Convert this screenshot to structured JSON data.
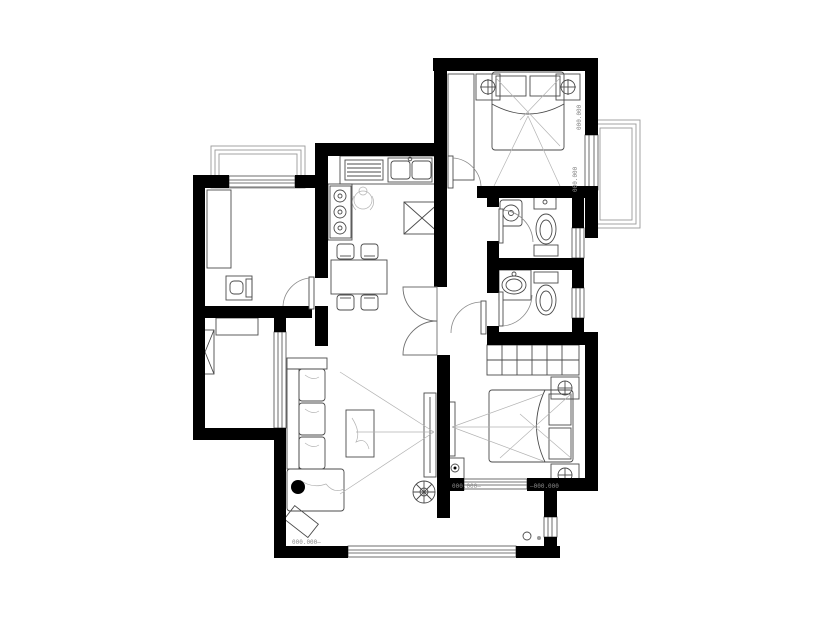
{
  "title": "apartment floor plan drawing",
  "colors": {
    "background": "#ffffff",
    "wall": "#000000",
    "furniture_line": "#4b4b4b",
    "light_guide_line": "#b3b3b3",
    "window_line": "#4a4a4a",
    "dimension_text": "#8a8a8a"
  },
  "dimension_labels": [
    {
      "text": "000.000—"
    },
    {
      "text": "000.000—"
    },
    {
      "text": "—000.000"
    },
    {
      "text": "000.000"
    },
    {
      "text": "000.000"
    }
  ],
  "rooms": [
    {
      "name": "bedroom-top-right",
      "furniture": [
        "wardrobe",
        "double-bed",
        "pillows",
        "nightstand-left",
        "nightstand-right",
        "table-lamps",
        "balcony-bay-window",
        "entry-door"
      ]
    },
    {
      "name": "kitchen",
      "furniture": [
        "counter",
        "double-sink",
        "dish-rack",
        "cooktop",
        "refrigerator",
        "figure"
      ]
    },
    {
      "name": "study-room",
      "furniture": [
        "wardrobe",
        "desk",
        "chair",
        "bay-window",
        "entry-door"
      ]
    },
    {
      "name": "bathroom-upper",
      "furniture": [
        "washing-machine",
        "small-basin",
        "toilet",
        "entry-door",
        "window"
      ]
    },
    {
      "name": "bathroom-lower",
      "furniture": [
        "vanity-counter",
        "basin",
        "toilet",
        "entry-door",
        "window"
      ]
    },
    {
      "name": "dining-area",
      "furniture": [
        "dining-table",
        "chairs-x4",
        "double-swing-door"
      ]
    },
    {
      "name": "living-room",
      "furniture": [
        "l-sofa",
        "chaise",
        "side-table",
        "coffee-table",
        "tv-stand",
        "plant",
        "west-window",
        "south-window"
      ]
    },
    {
      "name": "bedroom-bottom-right",
      "furniture": [
        "wardrobe",
        "double-bed",
        "pillows",
        "nightstand-top",
        "nightstand-bottom",
        "tv",
        "tv-cabinet",
        "south-window",
        "entry-door"
      ]
    },
    {
      "name": "ac-platform",
      "furniture": [
        "shaft-box",
        "ac-unit"
      ]
    },
    {
      "name": "utility-corner",
      "furniture": [
        "floor-drains",
        "window"
      ]
    }
  ]
}
